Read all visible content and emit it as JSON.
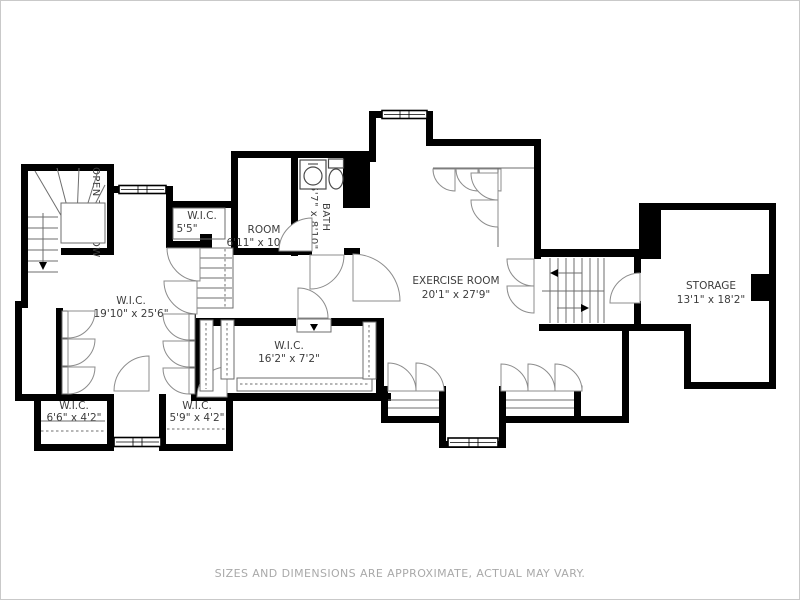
{
  "page": {
    "disclaimer": "SIZES AND DIMENSIONS ARE APPROXIMATE, ACTUAL MAY VARY."
  },
  "rooms": {
    "open_to_below": {
      "name": "OPEN TO BELOW"
    },
    "wic_top_small": {
      "name": "W.I.C.",
      "dims": "5'5\""
    },
    "room": {
      "name": "ROOM",
      "dims": "6'11\" x 10'10\""
    },
    "bath": {
      "name": "BATH",
      "dims": "5'7\" x 8'10\""
    },
    "exercise_room": {
      "name": "EXERCISE ROOM",
      "dims": "20'1\" x 27'9\""
    },
    "storage": {
      "name": "STORAGE",
      "dims": "13'1\" x 18'2\""
    },
    "wic_main": {
      "name": "W.I.C.",
      "dims": "19'10\" x 25'6\""
    },
    "wic_long": {
      "name": "W.I.C.",
      "dims": "16'2\" x 7'2\""
    },
    "wic_bottom_left": {
      "name": "W.I.C.",
      "dims": "6'6\" x 4'2\""
    },
    "wic_bottom_mid": {
      "name": "W.I.C.",
      "dims": "5'9\" x 4'2\""
    }
  }
}
